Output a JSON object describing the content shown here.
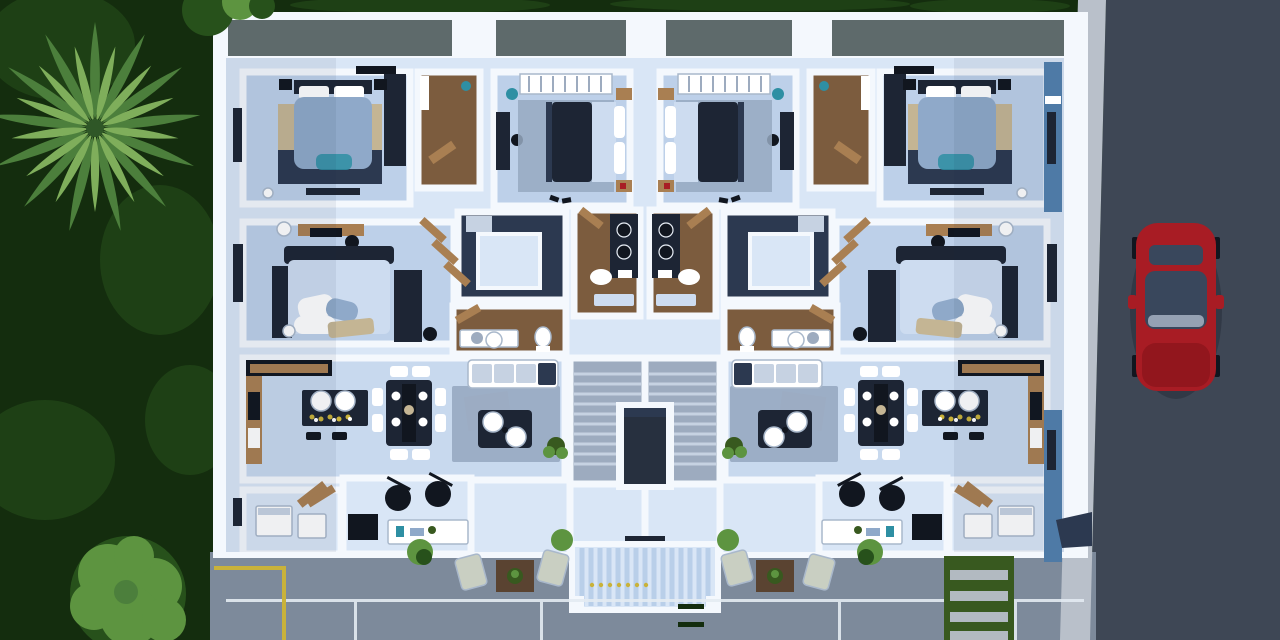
{
  "scene": {
    "description": "aerial-top-view-3d-render-of-two-unit-apartment-floor-plan",
    "environment": [
      "hedge-landscape",
      "palm-tree",
      "round-tree",
      "asphalt-road",
      "sidewalk",
      "red-car",
      "concrete-driveway",
      "parking-lines",
      "grass-paver-path"
    ],
    "building": {
      "units": 2,
      "layout": "mirrored-left-right",
      "unit_rooms": [
        "master-bedroom",
        "second-bedroom",
        "third-bedroom",
        "walkin-closet",
        "bathroom",
        "vanity-room",
        "open-plan-kitchen-dining-living",
        "bar-room",
        "laundry-room",
        "terrace"
      ],
      "shared": [
        "staircase",
        "elevator-shaft",
        "entrance-canopy"
      ]
    }
  },
  "colors": {
    "foliageDark": "#142d0e",
    "foliageMid": "#27511b",
    "treeLight": "#5d9440",
    "palmLight": "#7fae5b",
    "palmMid": "#4c7f3c",
    "palmDark": "#2f5727",
    "roadAsphalt": "#3e4755",
    "sidewalk": "#b9c0ca",
    "drivewayConcrete": "#7d8a9b",
    "lineWhite": "#e4ebf2",
    "lineYellow": "#c9b23a",
    "paverGrass": "#38591f",
    "wallWhite": "#f4f8fd",
    "parapetGray": "#5e6a6b",
    "facadeBlue": "#4e7aa6",
    "floorLight": "#d9e6f6",
    "floorPale": "#c8d9ee",
    "floorBedroom": "#bdd0e9",
    "woodFloor": "#7c5c3e",
    "woodLight": "#a97f52",
    "woodDark": "#5a4331",
    "navyDark": "#1d2534",
    "navyMid": "#2c3950",
    "duvetBlue": "#8fa9c9",
    "duvetLight": "#cddcf0",
    "rugGray": "#97a9c1",
    "rugTan": "#c4b594",
    "tealAccent": "#2e8fa3",
    "blackish": "#11161f",
    "stairConcrete": "#9dabbf",
    "stairLight": "#c6d2e2",
    "elevatorDark": "#27303f",
    "canopyStripe": "#b9cfe9",
    "loungeChair": "#c9cfc2",
    "white": "#ffffff",
    "carRed": "#a81c24",
    "carRedDark": "#7c1016",
    "carGlass": "#39475c",
    "shadow": "#1c2c4a"
  }
}
